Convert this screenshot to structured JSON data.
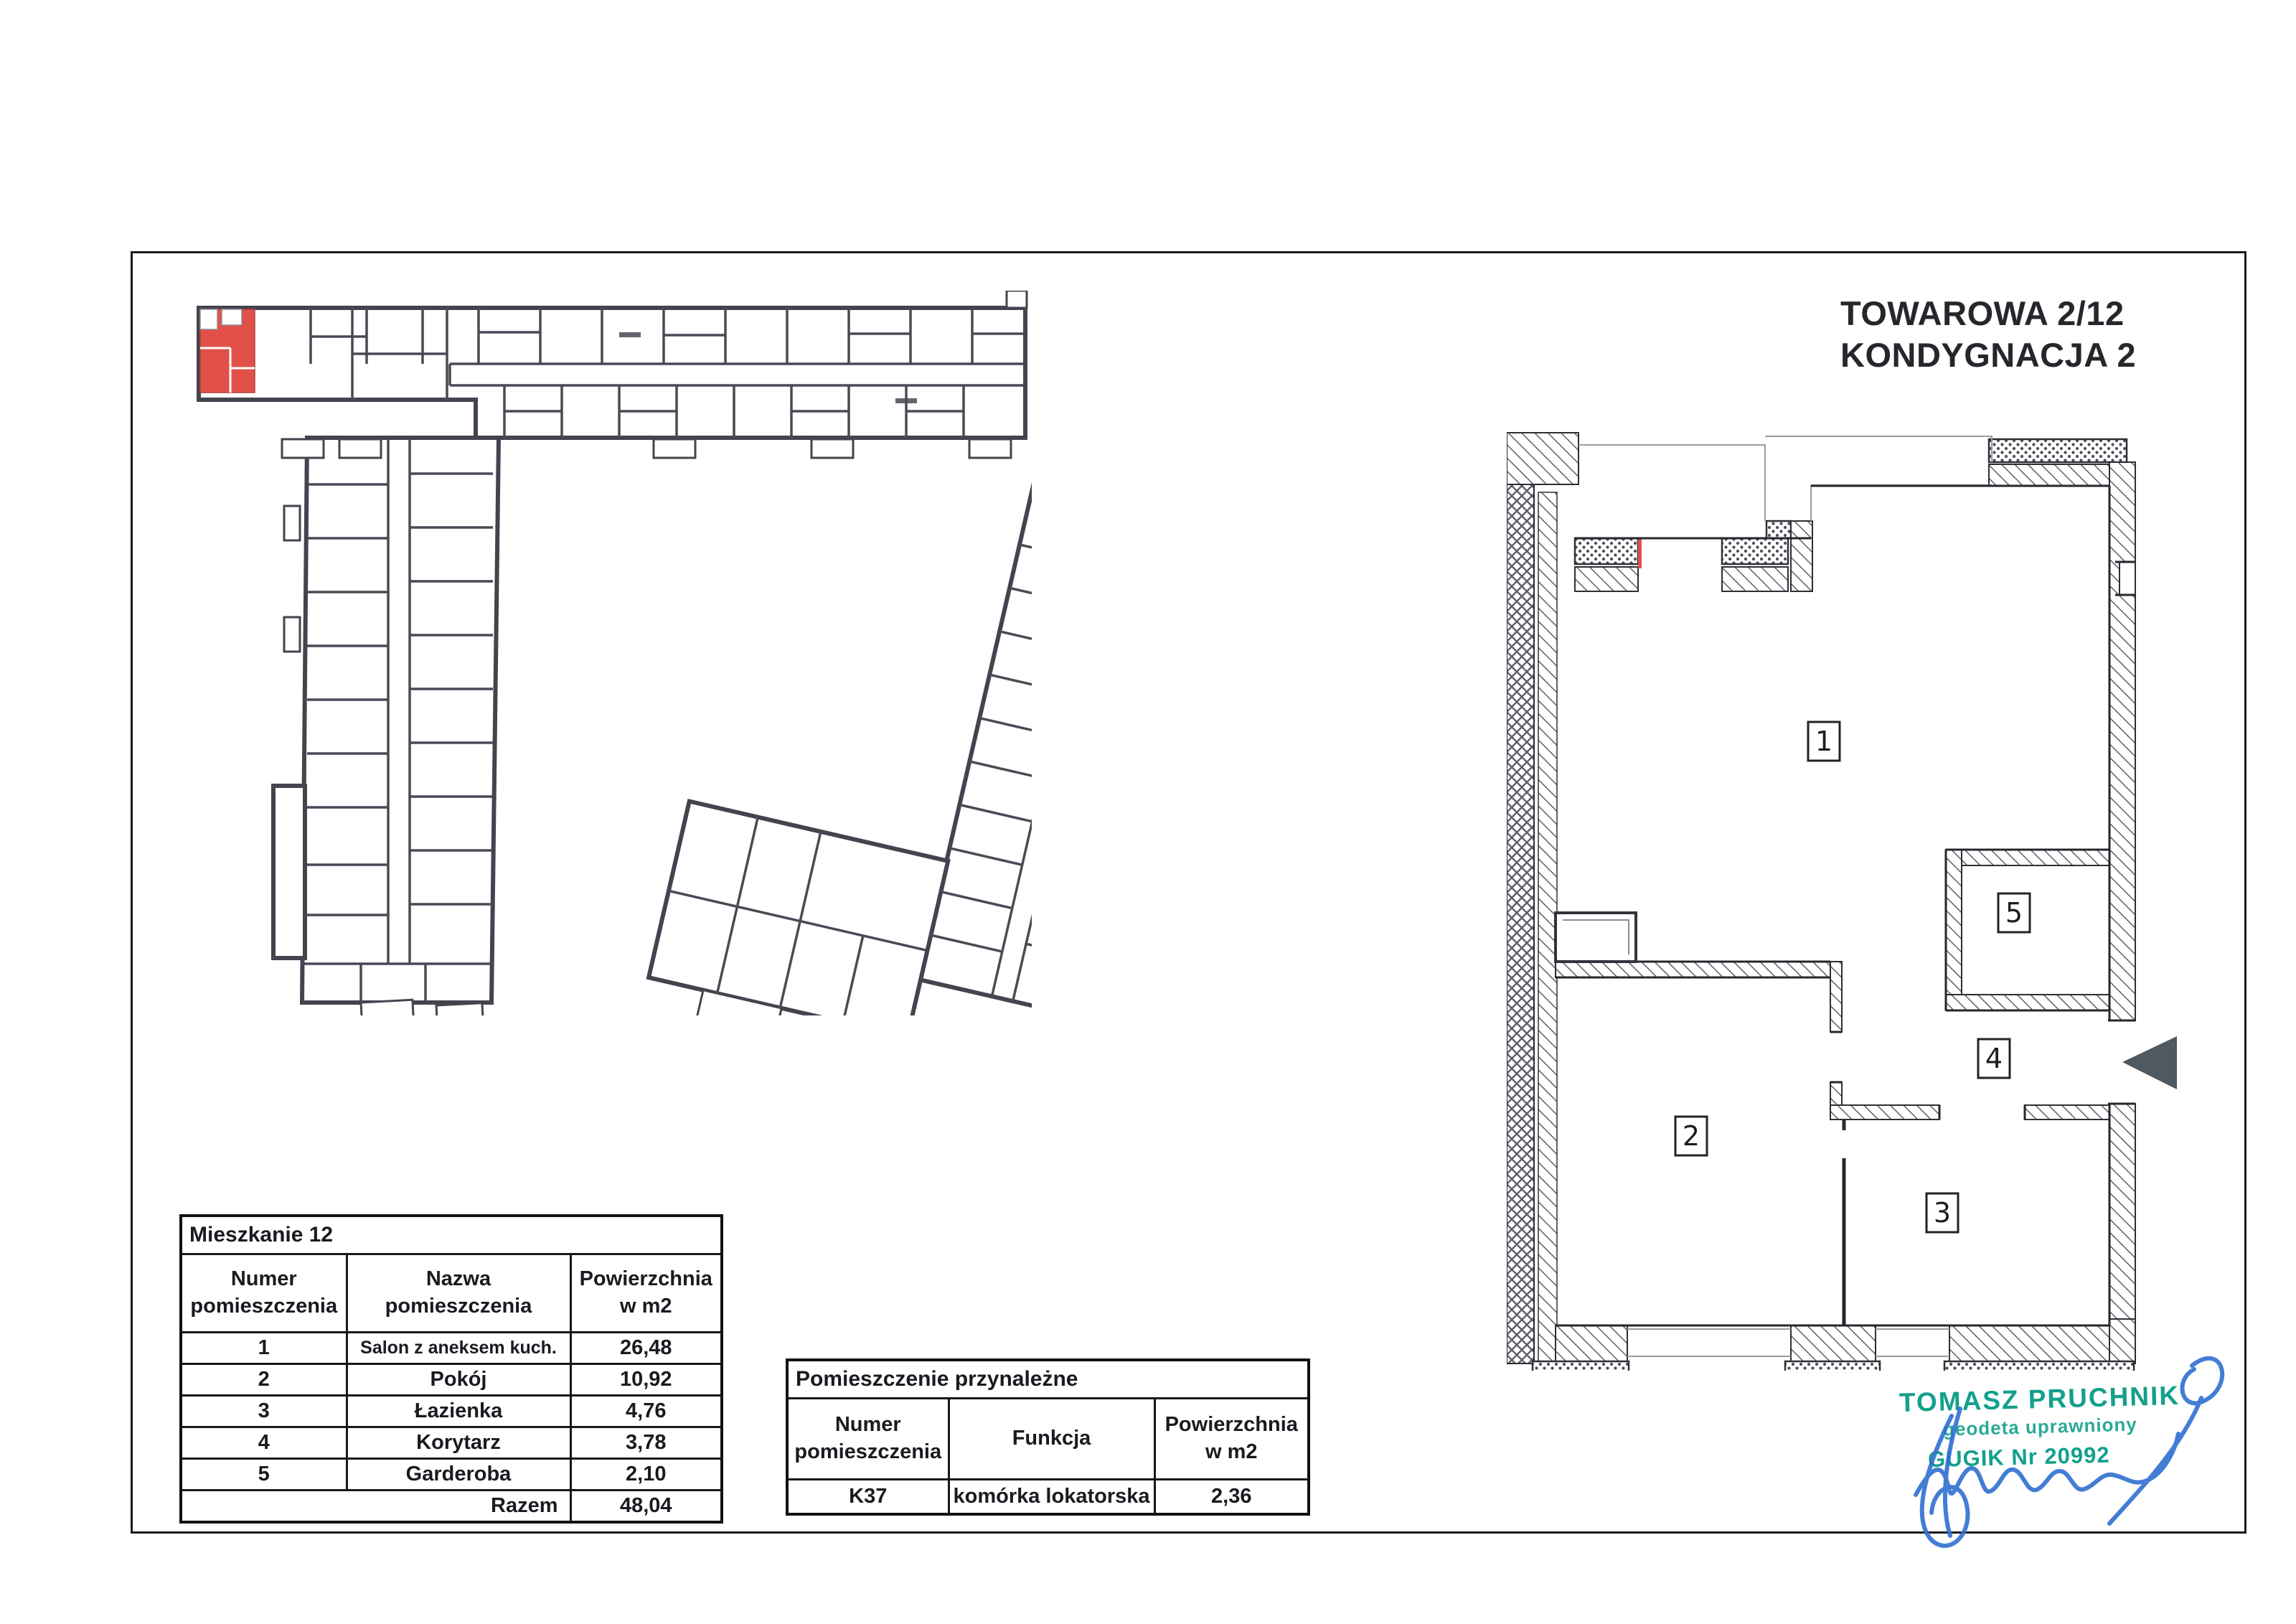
{
  "page": {
    "title_line1": "TOWAROWA 2/12",
    "title_line2": "KONDYGNACJA 2"
  },
  "colors": {
    "highlight_red": "#e2504a",
    "wall_dark": "#44444f",
    "stamp_green": "#13a08c",
    "signature_blue": "#2f6fd0",
    "entrance_arrow_gray": "#4e5962"
  },
  "detail_plan": {
    "rooms": [
      "1",
      "2",
      "3",
      "4",
      "5"
    ]
  },
  "tables": {
    "mieszkanie": {
      "title": "Mieszkanie 12",
      "col_numer": "Numer\npomieszczenia",
      "col_nazwa": "Nazwa\npomieszczenia",
      "col_pow": "Powierzchnia\nw m2",
      "rows": [
        {
          "nr": "1",
          "nazwa": "Salon z aneksem kuch.",
          "pow": "26,48"
        },
        {
          "nr": "2",
          "nazwa": "Pokój",
          "pow": "10,92"
        },
        {
          "nr": "3",
          "nazwa": "Łazienka",
          "pow": "4,76"
        },
        {
          "nr": "4",
          "nazwa": "Korytarz",
          "pow": "3,78"
        },
        {
          "nr": "5",
          "nazwa": "Garderoba",
          "pow": "2,10"
        }
      ],
      "razem_label": "Razem",
      "razem_value": "48,04"
    },
    "przynalezne": {
      "title": "Pomieszczenie przynależne",
      "col_numer": "Numer\npomieszczenia",
      "col_funkcja": "Funkcja",
      "col_pow": "Powierzchnia\nw m2",
      "row": {
        "nr": "K37",
        "funkcja": "komórka lokatorska",
        "pow": "2,36"
      }
    }
  },
  "stamp": {
    "line1": "TOMASZ PRUCHNIK",
    "line2": "geodeta uprawniony",
    "line3": "GUGIK Nr 20992"
  }
}
